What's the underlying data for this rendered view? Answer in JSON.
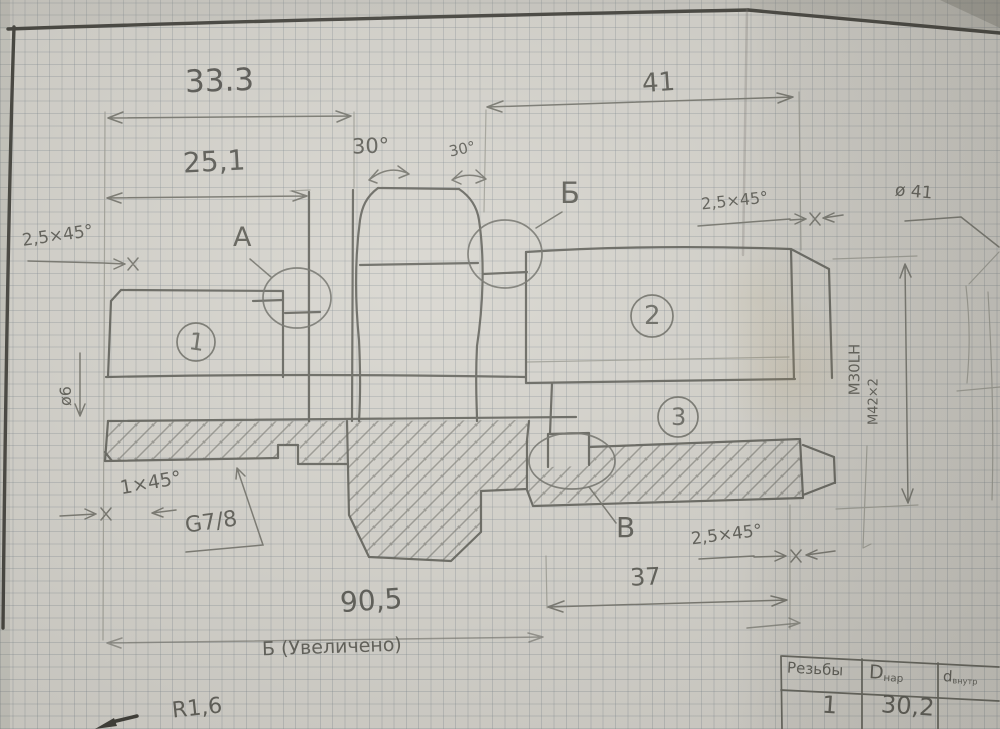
{
  "colors": {
    "paper": "#d7d5ce",
    "grid_line": "#8c949a",
    "pencil": "#63635d",
    "frame": "#41403b"
  },
  "drawing": {
    "dims": {
      "top_width": "33.3",
      "inner_width": "25,1",
      "right_width": "41",
      "bottom_length": "90,5",
      "right_length": "37",
      "chamfer_tl": "2,5×45°",
      "chamfer_tr": "2,5×45°",
      "chamfer_bl": "1×45°",
      "chamfer_br": "2,5×45°",
      "angle_left": "30°",
      "angle_right": "30°",
      "dia_small": "ø6",
      "dia_right": "ø 41",
      "radius": "R1,6"
    },
    "threads": {
      "g": "G7/8",
      "m1": "M30LH",
      "m2": "М42×2"
    },
    "details": {
      "a": "А",
      "b": "Б",
      "v": "В"
    },
    "parts": {
      "p1": "1",
      "p2": "2",
      "p3": "3"
    },
    "caption": "Б (Увеличено)",
    "table": {
      "h1": "Резьбы",
      "h2_main": "D",
      "h2_sub": "нар",
      "h3_main": "d",
      "h3_sub": "внутр",
      "r1c1": "1",
      "r1c2": "30,2"
    }
  }
}
